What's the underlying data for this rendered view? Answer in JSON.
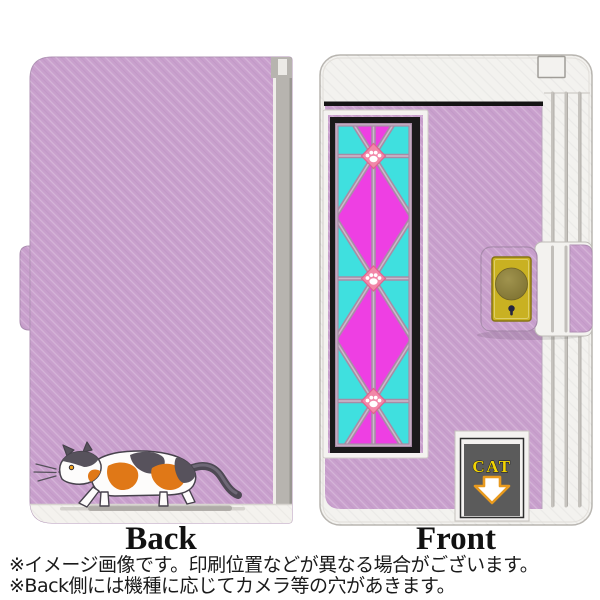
{
  "views": {
    "back": {
      "label": "Back"
    },
    "front": {
      "label": "Front",
      "badge_text": "CAT"
    }
  },
  "footnotes": [
    "※イメージ画像です。印刷位置などが異なる場合がございます。",
    "※Back側には機種に応じてカメラ等の穴があきます。"
  ],
  "colors": {
    "case_purple": "#c9a0cd",
    "case_white": "#f3f2ef",
    "trim_black": "#141414",
    "pattern_magenta": "#ee3fe3",
    "pattern_cyan": "#3fe0df",
    "lattice_mauve": "#a78ca6",
    "paw_diamond_pink": "#f287a8",
    "clasp_gold": "#c9b122",
    "badge_panel_gray": "#5b5b5b",
    "badge_text_yellow": "#f2d404",
    "arrow_outline_orange": "#e89a1e",
    "cat_patch_orange": "#e07817",
    "cat_patch_gray": "#57525c"
  },
  "icons": {
    "paw_print": "paw-print-icon",
    "down_arrow": "down-arrow-icon",
    "keyhole": "keyhole-icon",
    "clasp_button": "clasp-button-icon"
  }
}
